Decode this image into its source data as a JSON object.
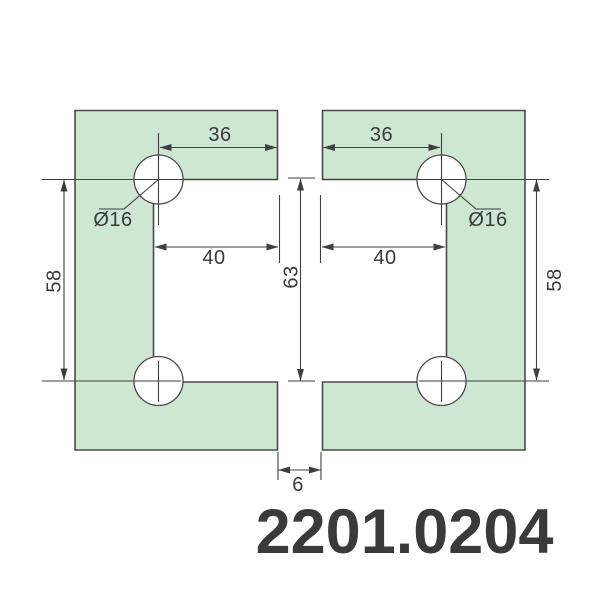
{
  "product_code": "2201.0204",
  "dims": {
    "hole_offset_top": "36",
    "hole_diameter": "Ø16",
    "cutout_width": "40",
    "hole_spacing": "58",
    "cutout_height": "63",
    "glass_gap": "6"
  },
  "colors": {
    "plate_fill": "#cde7d3",
    "line": "#3f3f3f",
    "accent_red": "#ae2b2d"
  }
}
